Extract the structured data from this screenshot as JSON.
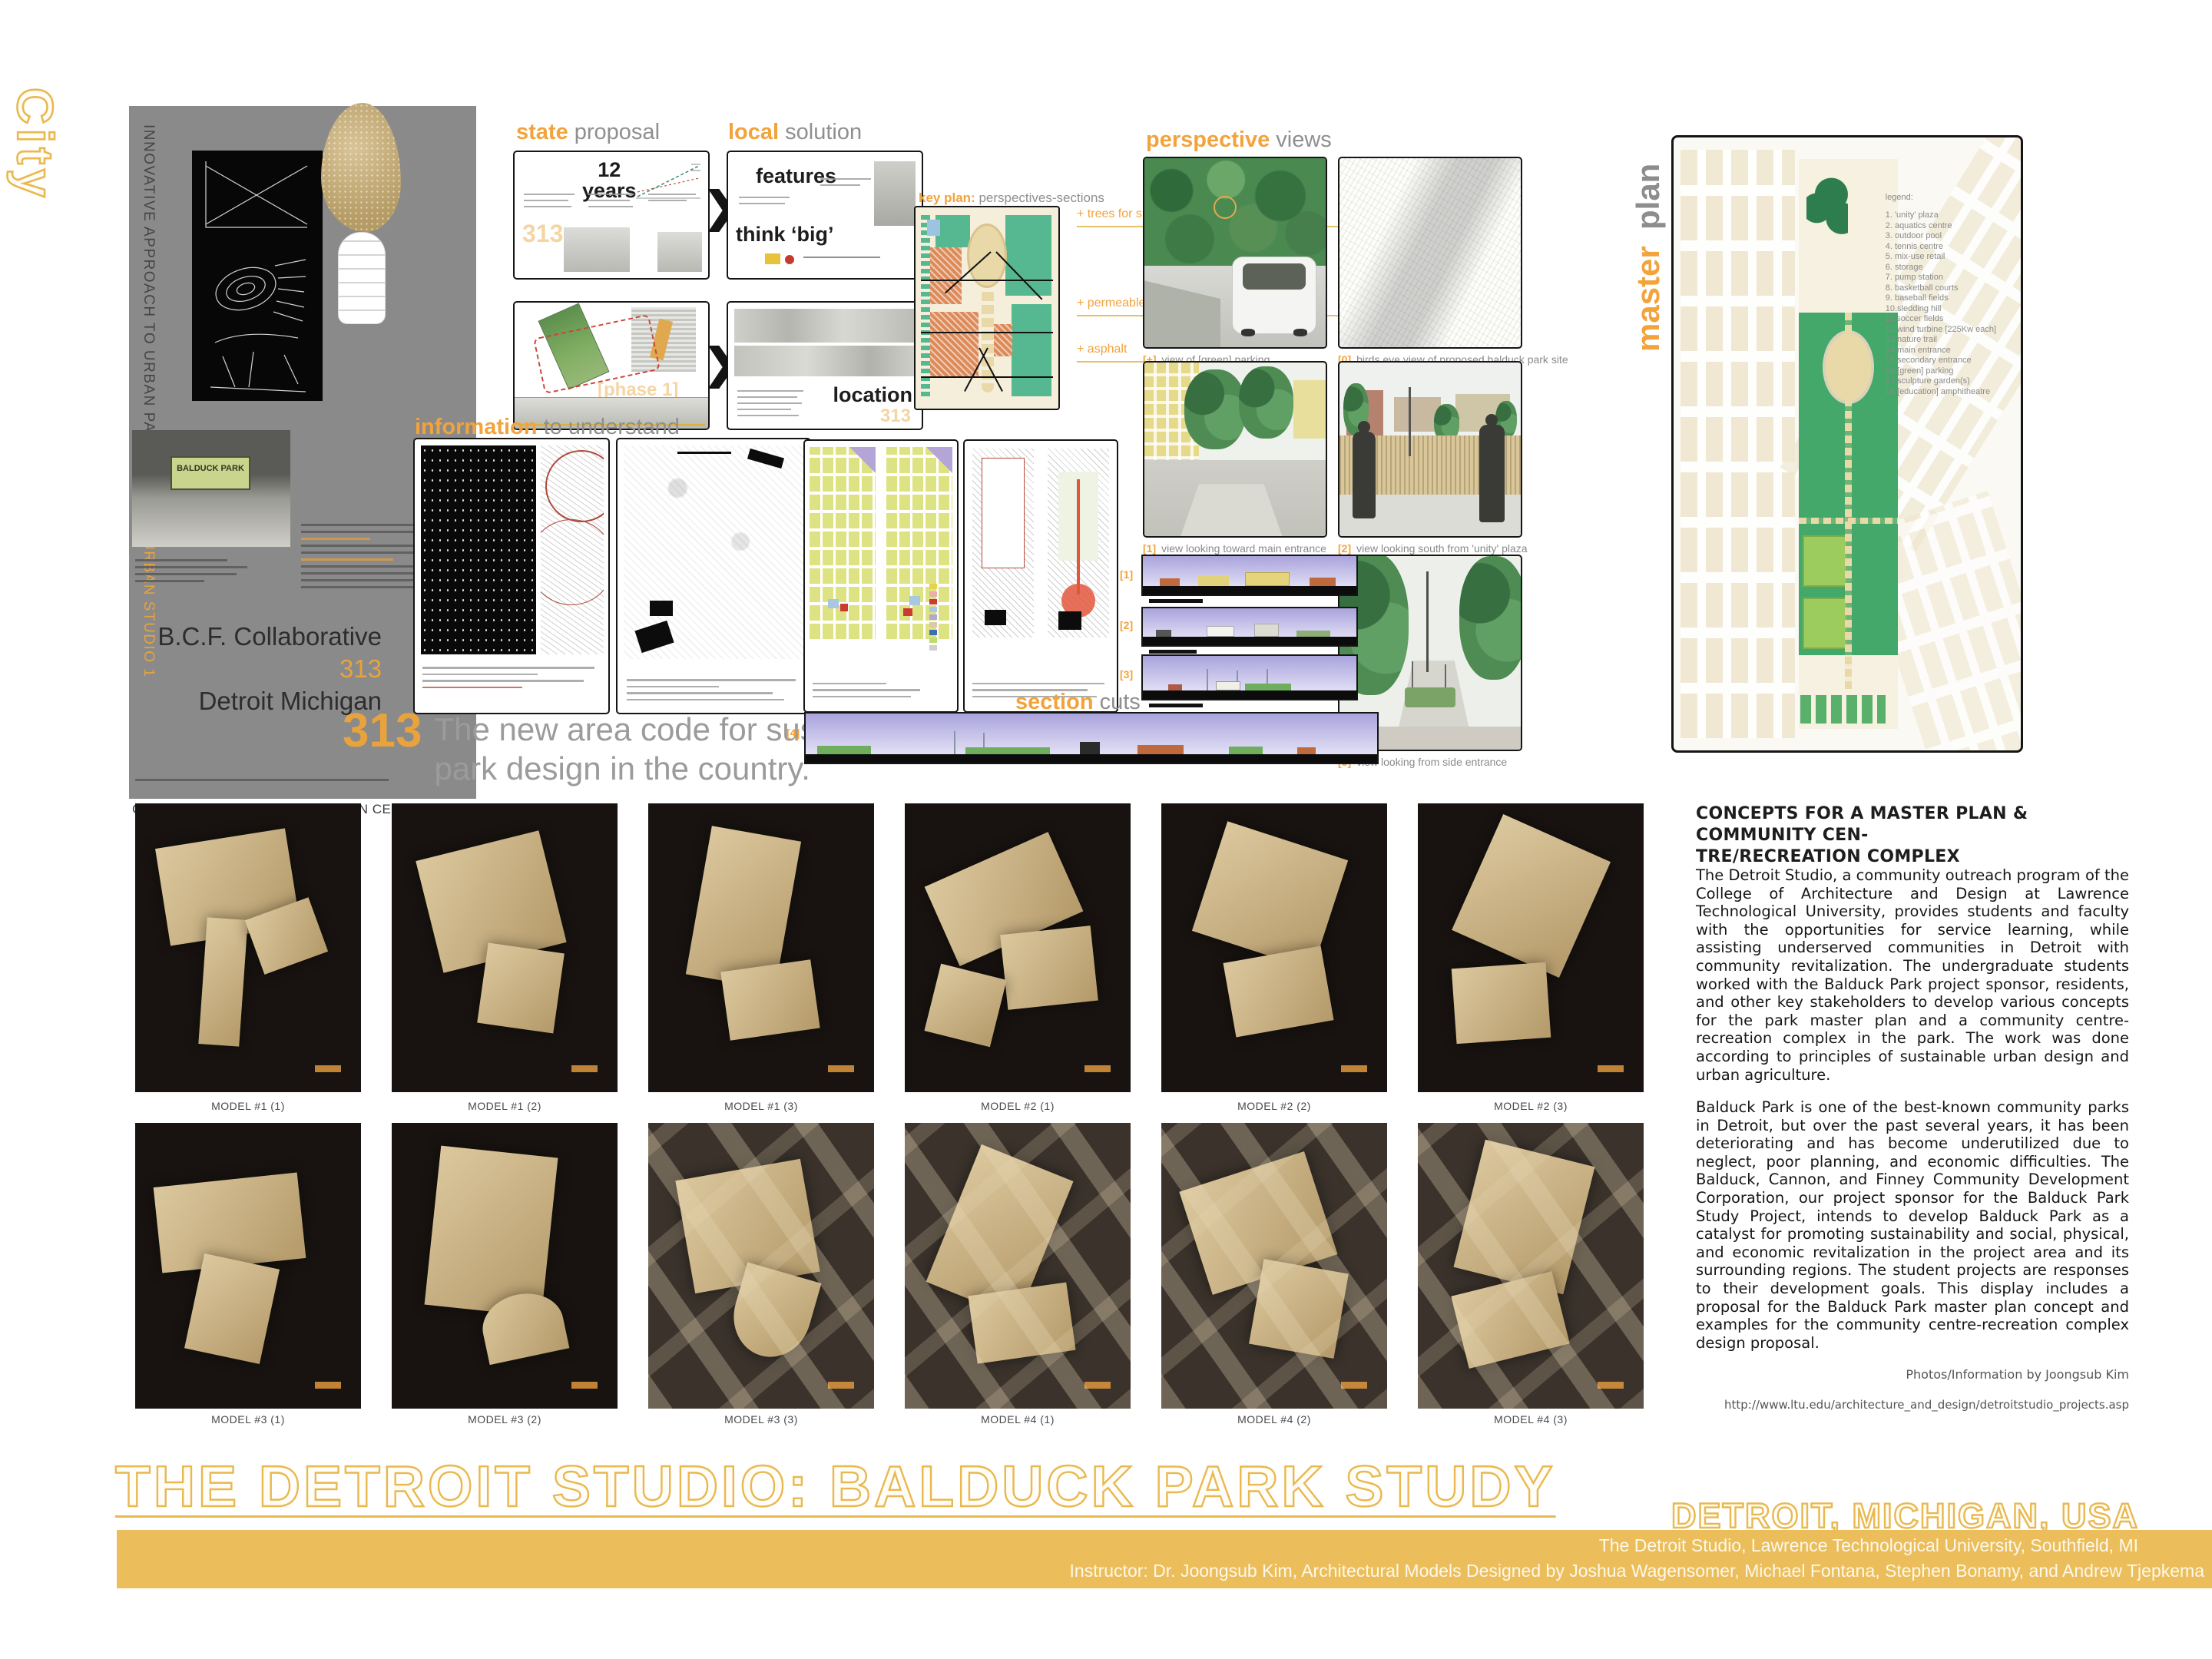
{
  "colors": {
    "accent_orange": "#F2A33C",
    "gold_outline": "#E9B84F",
    "bar_gold": "#ECBE5B",
    "panel_gray": "#8A8A8A",
    "section_sky": "#A9A3DC"
  },
  "left_column": {
    "city_label": "City",
    "vertical_note": "INNOVATIVE APPROACH TO URBAN PARK DESIGN",
    "vertical_note_accent": "URBAN STUDIO 1",
    "park_sign": "BALDUCK PARK",
    "firm_name": "B.C.F. Collaborative",
    "firm_number": "313",
    "firm_city": "Detroit Michigan",
    "caption": "COMMUNITY CENTRE/RECREATION CENTER. MASTER PLAN"
  },
  "area_code": {
    "number": "313",
    "line1": "The new area code for sustainable",
    "line2": "park design in the country."
  },
  "state_section": {
    "header_accent": "state",
    "header_rest": "proposal",
    "years_top": "12",
    "years_bottom": "years",
    "code": "313",
    "phase": "[phase 1]"
  },
  "local_section": {
    "header_accent": "local",
    "header_rest": "solution",
    "features": "features",
    "think_big": "think ‘big’",
    "location": "location",
    "code": "313"
  },
  "info_section": {
    "header_accent": "information",
    "header_rest": "to understand"
  },
  "key_plan": {
    "header_accent": "key plan:",
    "header_rest": "perspectives-sections",
    "leaders": [
      "+ trees for shade",
      "+ permeable pavers",
      "+ asphalt"
    ]
  },
  "perspectives": {
    "header_accent": "perspective",
    "header_rest": "views",
    "captions": [
      {
        "tag": "[+]",
        "text": "view of [green] parking"
      },
      {
        "tag": "[0]",
        "text": "birds eye view of proposed balduck park site"
      },
      {
        "tag": "[1]",
        "text": "view looking toward main entrance"
      },
      {
        "tag": "[2]",
        "text": "view looking south from 'unity' plaza"
      },
      {
        "tag": "[3]",
        "text": "view looking from side entrance"
      }
    ]
  },
  "section_cuts": {
    "header_accent": "section",
    "header_rest": "cuts",
    "labels": [
      "[1]",
      "[2]",
      "[3]",
      "[4]"
    ]
  },
  "master_plan": {
    "label_accent": "master",
    "label_rest": "plan",
    "legend_title": "legend:",
    "legend_items": [
      "1. 'unity' plaza",
      "2. aquatics centre",
      "3. outdoor pool",
      "4. tennis centre",
      "5. mix-use retail",
      "6. storage",
      "7. pump station",
      "8. basketball courts",
      "9. baseball fields",
      "10.sledding hill",
      "11.soccer fields",
      "12.wind turbine [225Kw each]",
      "13.nature trail",
      "14.main entrance",
      "15.secondary entrance",
      "16.[green] parking",
      "17.sculpture garden(s)",
      "18.[education] amphitheatre"
    ]
  },
  "concepts": {
    "heading_line1": "CONCEPTS FOR A MASTER PLAN & COMMUNITY CEN-",
    "heading_line2": "TRE/RECREATION COMPLEX",
    "paragraph1": "The Detroit Studio, a community outreach program of the College of Architecture and Design at Lawrence Technological University, provides students and faculty with the opportunities for service learning, while assisting underserved communities in Detroit with community revitalization. The undergraduate students worked with the Balduck Park project sponsor, residents, and other key stakeholders to develop various concepts for the park master plan and a community centre-recreation complex in the park. The work was done according to principles of sustainable urban design and urban agriculture.",
    "paragraph2": "Balduck Park is one of the best-known community parks in Detroit, but over the past several years, it has been deteriorating and has become underutilized due to neglect, poor planning, and economic difficulties. The Balduck, Cannon, and Finney Community Development Corporation, our project sponsor for the Balduck Park Study Project, intends to develop Balduck Park as a catalyst for promoting sustainability and social, physical, and economic revitalization in the project area and its surrounding regions. The student projects are responses to their development goals. This display includes a proposal for the Balduck Park master plan concept and examples for the community centre-recreation complex design proposal.",
    "credit": "Photos/Information by Joongsub Kim",
    "url": "http://www.ltu.edu/architecture_and_design/detroitstudio_projects.asp"
  },
  "models": {
    "labels": [
      "MODEL #1 (1)",
      "MODEL #1 (2)",
      "MODEL #1 (3)",
      "MODEL #2 (1)",
      "MODEL #2 (2)",
      "MODEL #2 (3)",
      "MODEL #3 (1)",
      "MODEL #3 (2)",
      "MODEL #3 (3)",
      "MODEL #4 (1)",
      "MODEL #4 (2)",
      "MODEL #4 (3)"
    ]
  },
  "footer": {
    "title": "THE DETROIT STUDIO: BALDUCK PARK STUDY",
    "location": "DETROIT, MICHIGAN, USA",
    "affiliation": "The Detroit Studio, Lawrence Technological University, Southfield, MI",
    "credits": "Instructor: Dr. Joongsub Kim, Architectural Models Designed by Joshua Wagensomer, Michael Fontana, Stephen Bonamy, and Andrew Tjepkema"
  }
}
